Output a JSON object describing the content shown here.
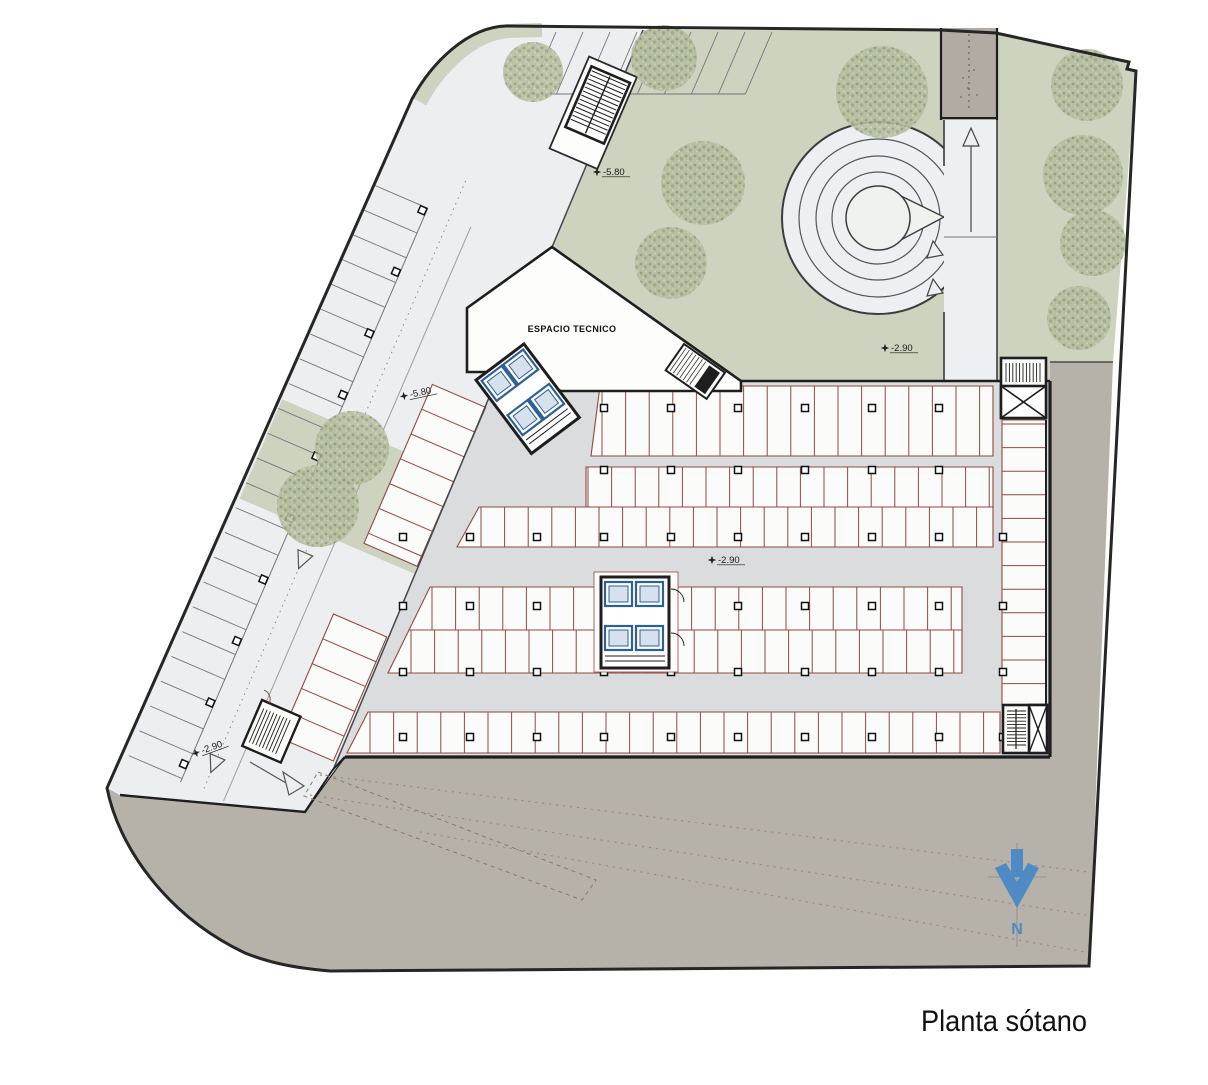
{
  "title": "Planta sótano",
  "labels": {
    "espacio_tecnico": "ESPACIO TECNICO",
    "north": "N"
  },
  "colors": {
    "ground": "#b6b1a9",
    "green": "#cdd3bf",
    "tree_base": "#b4bd9f",
    "strip": "#eceef0",
    "floor": "#dadcde",
    "stall_fill": "#fbfbfa",
    "stall_outline": "#8e4a42",
    "wall": "#1e1e1e",
    "thin_line": "#70757a",
    "elevator_blue": "#2e6096",
    "elevator_fill": "#d5e2ee",
    "north_blue": "#4e8bc4",
    "dotted_ground": "#9b8b81"
  },
  "elevation_markers": [
    {
      "text": "-5.80",
      "x": 597,
      "y": 172,
      "rot": 0
    },
    {
      "text": "-5.80",
      "x": 404,
      "y": 396,
      "rot": -12
    },
    {
      "text": "-2.90",
      "x": 885,
      "y": 348,
      "rot": 0
    },
    {
      "text": "-2.90",
      "x": 712,
      "y": 560,
      "rot": 0
    },
    {
      "text": "-2.90",
      "x": 196,
      "y": 753,
      "rot": -20
    }
  ],
  "trees": [
    {
      "x": 533,
      "y": 72,
      "r": 30
    },
    {
      "x": 664,
      "y": 58,
      "r": 33
    },
    {
      "x": 703,
      "y": 183,
      "r": 42
    },
    {
      "x": 671,
      "y": 263,
      "r": 36
    },
    {
      "x": 882,
      "y": 92,
      "r": 46
    },
    {
      "x": 352,
      "y": 448,
      "r": 37
    },
    {
      "x": 318,
      "y": 506,
      "r": 41
    },
    {
      "x": 1087,
      "y": 85,
      "r": 36
    },
    {
      "x": 1083,
      "y": 175,
      "r": 40
    },
    {
      "x": 1093,
      "y": 243,
      "r": 33
    },
    {
      "x": 1079,
      "y": 318,
      "r": 32
    }
  ],
  "parking": {
    "stall_step": 23.6,
    "bands": [
      {
        "name": "row-top",
        "pts": "600,386 993,386 993,456 591,456",
        "div": "v",
        "from": 602,
        "to": 991,
        "y0": 386,
        "y1": 456
      },
      {
        "name": "row-2a",
        "pts": "586,467 993,467 993,507 586,507",
        "div": "v",
        "from": 588,
        "to": 991,
        "y0": 467,
        "y1": 507
      },
      {
        "name": "row-2b",
        "pts": "479,507 993,507 993,547 457,547",
        "div": "v",
        "from": 481,
        "to": 991,
        "y0": 507,
        "y1": 547
      },
      {
        "name": "row-3a",
        "pts": "430,587 962,587 962,630 409,630",
        "div": "v",
        "from": 432,
        "to": 960,
        "y0": 587,
        "y1": 630
      },
      {
        "name": "row-3b",
        "pts": "409,630 962,630 962,673 388,673",
        "div": "v",
        "from": 411,
        "to": 960,
        "y0": 630,
        "y1": 673
      },
      {
        "name": "row-bottom",
        "pts": "368,712 1000,712 1000,753 347,753",
        "div": "v",
        "from": 370,
        "to": 998,
        "y0": 712,
        "y1": 753
      },
      {
        "name": "row-right",
        "pts": "1002,420 1046,420 1046,705 1002,705",
        "div": "h",
        "from": 424,
        "to": 703,
        "x0": 1002,
        "x1": 1046
      }
    ],
    "strip_rows": {
      "gray": {
        "from": 95,
        "to": 720,
        "step": 27,
        "x0": 0,
        "x1": 58
      },
      "redA": {
        "from": 255,
        "to": 428,
        "step": 27,
        "x0": 132,
        "x1": 190
      },
      "redB": {
        "from": 505,
        "to": 640,
        "step": 27,
        "x0": 132,
        "x1": 190
      },
      "top": {
        "x0": 556,
        "count": 8,
        "step": 27,
        "y0": 32,
        "y1": 94,
        "lean": -26.6
      }
    },
    "columns": {
      "xs": [
        403,
        470,
        537,
        604,
        671,
        738,
        805,
        872,
        939
      ],
      "ys_upper": [
        408,
        470
      ],
      "ys_lower": [
        537,
        606,
        672,
        737
      ],
      "right_x": 1003,
      "strip_x": 54,
      "strip_from": 99,
      "strip_to": 713,
      "strip_step": 67
    }
  },
  "ground_dotted_lines": [
    [
      320,
      775,
      1088,
      872
    ],
    [
      310,
      795,
      1086,
      915
    ],
    [
      420,
      832,
      1085,
      952
    ]
  ],
  "dashed_wedge": "318,772 596,880 582,900 304,796"
}
